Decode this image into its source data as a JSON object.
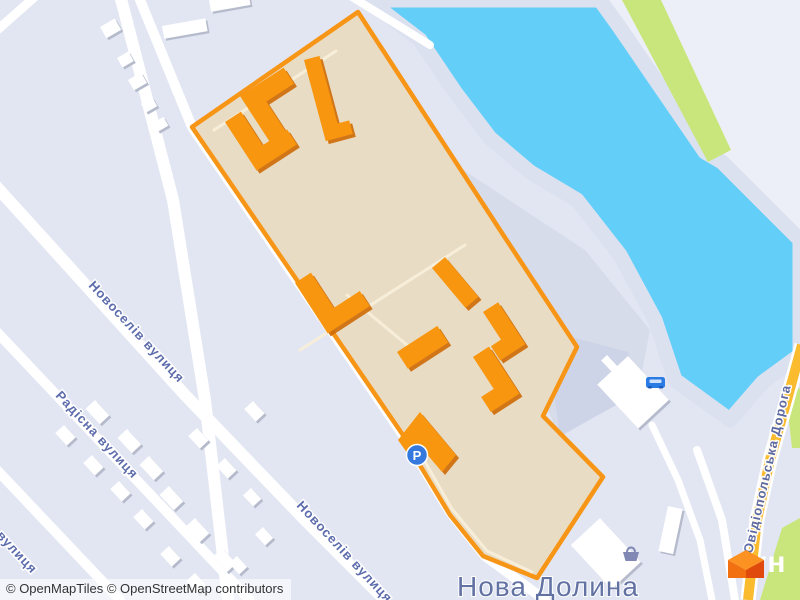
{
  "map": {
    "place_label": "Нова Долина",
    "streets": {
      "novoseliv_upper": "Новоселів вулиця",
      "novoseliv_lower": "Новоселів вулиця",
      "radisna": "Радісна вулиця",
      "partial_left_edge": "вулиця",
      "ovidiopolska": "Овідіопольська Дорога"
    },
    "pois": {
      "parking_label": "P",
      "parking_icon": "parking-icon",
      "car_icon": "car-icon",
      "shop_icon": "shopping-basket-icon"
    },
    "colors": {
      "land": "#E2E6F3",
      "land_pale": "#ECEFF8",
      "water": "#63CFF8",
      "shore": "#DCE1F0",
      "greenery": "#C9E67C",
      "development_fill": "#E9DCC4",
      "development_border": "#F79517",
      "building_orange": "#F8960F",
      "road_yellow": "#FBBB2F",
      "label_blue": "#5565A8",
      "place_label_blue": "#6272A3",
      "logo_orange": "#F2700F"
    }
  },
  "attribution": {
    "text": "© OpenMapTiles © OpenStreetMap contributors"
  },
  "logo": {
    "wordmark": "лун",
    "cube_icon": "lun-cube-icon"
  }
}
